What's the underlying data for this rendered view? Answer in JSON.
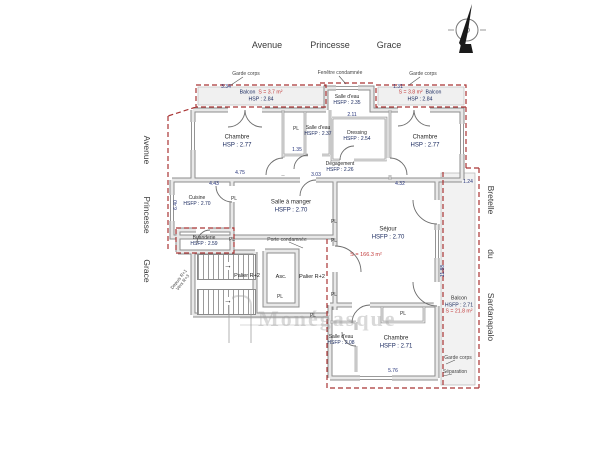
{
  "streets": {
    "top": [
      "Avenue",
      "Princesse",
      "Grace"
    ],
    "left": [
      "Avenue",
      "Princesse",
      "Grace"
    ],
    "right": [
      "Bretelle",
      "du",
      "Sardanapalo"
    ]
  },
  "rooms": [
    {
      "name": "Chambre",
      "h": "HSP : 2.77"
    },
    {
      "name": "Salle d'eau",
      "h": "HSFP : 2.37"
    },
    {
      "name": "Dressing",
      "h": "HSFP : 2.54"
    },
    {
      "name": "Salle d'eau",
      "h": "HSFP : 2.35"
    },
    {
      "name": "Chambre",
      "h": "HSP : 2.77"
    },
    {
      "name": "Dégagement",
      "h": "HSFP : 2.26"
    },
    {
      "name": "Cuisine",
      "h": "HSFP : 2.70"
    },
    {
      "name": "Salle à manger",
      "h": "HSFP : 2.70"
    },
    {
      "name": "Buanderie",
      "h": "HSFP : 2.59"
    },
    {
      "name": "Séjour",
      "h": "HSFP : 2.70"
    },
    {
      "name": "Chambre",
      "h": "HSFP : 2.71"
    },
    {
      "name": "Salle d'eau",
      "h": "HSFP : 2.08"
    }
  ],
  "balconies": [
    {
      "name": "Balcon",
      "area": "S = 3.7 m²",
      "height": "HSP : 2.84"
    },
    {
      "name": "Balcon",
      "area": "S = 3.8 m²",
      "height": "HSP : 2.84"
    },
    {
      "name": "Balcon",
      "area": "S = 21.8 m²",
      "height": "HSFP : 2.71"
    }
  ],
  "circulation": {
    "palier_left": "Palier R+2",
    "palier_right": "Palier R+2",
    "elevator": "Asc.",
    "stairs_from": "Depuis R+1",
    "stairs_to": "Vers R+3"
  },
  "annotations": {
    "garde_corps": "Garde corps",
    "fenetre_condamnee": "Fenêtre condamnée",
    "porte_condamnee": "Porte condamnée",
    "separation": "Séparation",
    "total_surface": "S = 166.3 m²",
    "closet_label": "PL"
  },
  "watermark_text": "Monégasque",
  "colors": {
    "boundary_dash": "#a93434",
    "wall_edge": "#8d8d8d",
    "label_blue": "#16265c",
    "area_red": "#c23b3b"
  },
  "dimensions": [
    {
      "t": "3.34",
      "x": 226,
      "y": 87,
      "r": 0
    },
    {
      "t": "1.31",
      "x": 398,
      "y": 87,
      "r": 0
    },
    {
      "t": "2.11",
      "x": 352,
      "y": 115,
      "r": 0
    },
    {
      "t": "1.35",
      "x": 297,
      "y": 150,
      "r": 0
    },
    {
      "t": "4.75",
      "x": 240,
      "y": 173,
      "r": 0
    },
    {
      "t": "3.03",
      "x": 316,
      "y": 175,
      "r": 0
    },
    {
      "t": "4.43",
      "x": 214,
      "y": 184,
      "r": 0
    },
    {
      "t": "4.32",
      "x": 400,
      "y": 184,
      "r": 0
    },
    {
      "t": "6.40",
      "x": 176,
      "y": 205,
      "r": -90
    },
    {
      "t": "11.88",
      "x": 443,
      "y": 271,
      "r": -90
    },
    {
      "t": "5.76",
      "x": 393,
      "y": 371,
      "r": 0
    },
    {
      "t": "1.24",
      "x": 468,
      "y": 182,
      "r": 0
    }
  ],
  "closets": [
    [
      296,
      129
    ],
    [
      234,
      199
    ],
    [
      232,
      240
    ],
    [
      280,
      297
    ],
    [
      334,
      222
    ],
    [
      334,
      241
    ],
    [
      334,
      295
    ],
    [
      403,
      314
    ],
    [
      313,
      316
    ]
  ]
}
